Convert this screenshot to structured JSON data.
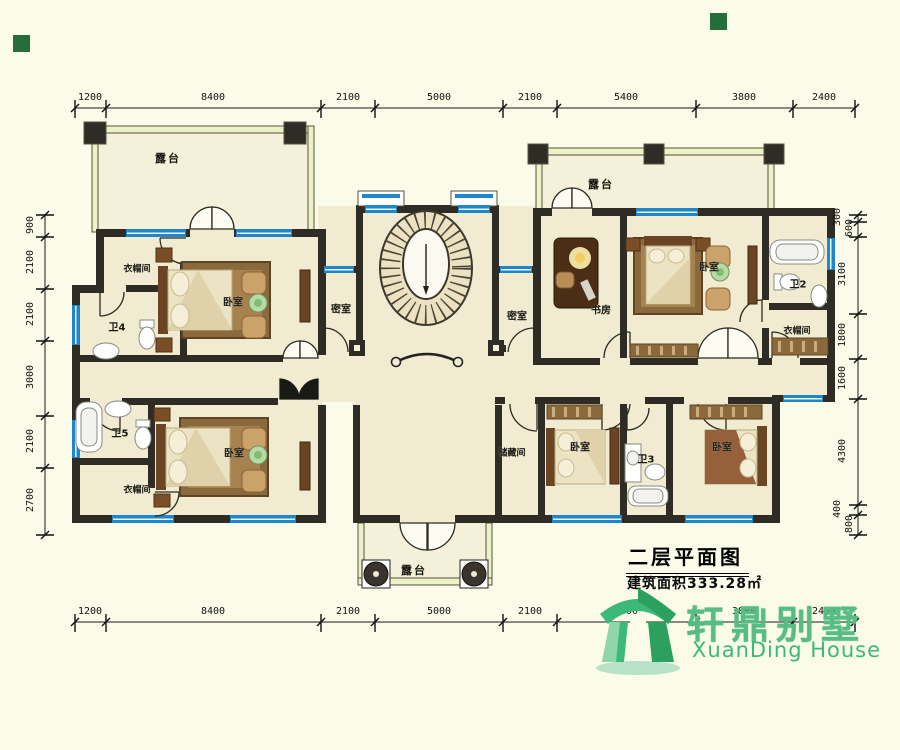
{
  "title": {
    "text": "二层平面图",
    "area": "建筑面积333.28㎡"
  },
  "logo": {
    "cn": "轩鼎别墅",
    "en": "XuanDing House"
  },
  "rooms": {
    "terrace_tl": "露台",
    "terrace_tr": "露台",
    "terrace_bottom": "露台",
    "closet_tl": "衣帽间",
    "bath4": "卫4",
    "bedroom_tl": "卧室",
    "secret_left": "密室",
    "secret_right": "密室",
    "study": "书房",
    "bedroom_tr": "卧室",
    "bath2": "卫2",
    "closet_tr": "衣帽间",
    "bath5": "卫5",
    "closet_bl": "衣帽间",
    "bedroom_bl": "卧室",
    "storage": "储藏间",
    "bedroom_bm": "卧室",
    "bath3": "卫3",
    "bedroom_br": "卧室"
  },
  "dimensions": {
    "top": [
      "1200",
      "8400",
      "2100",
      "5000",
      "2100",
      "5400",
      "3800",
      "2400"
    ],
    "bottom": [
      "1200",
      "8400",
      "2100",
      "5000",
      "2100",
      "5400",
      "3800",
      "2400"
    ],
    "left": [
      "900",
      "2100",
      "2100",
      "3000",
      "2100",
      "2700"
    ],
    "right": [
      "300",
      "600",
      "3100",
      "1800",
      "1600",
      "4300",
      "400",
      "800"
    ]
  },
  "icons": {
    "logo": "pavilion-house-icon",
    "staircase": "oval-staircase-icon",
    "corner_markers": "green-square-marker"
  },
  "colors": {
    "wall": "#2e2c24",
    "window_blue": "#1f86c9",
    "floor": "#f1ebd2",
    "terrace_floor": "#f4f0d9",
    "rail_fill": "#edf2c6",
    "logo_green": "#3cb878",
    "wood_dark": "#6b4423",
    "wood_mid": "#9a6a39"
  }
}
